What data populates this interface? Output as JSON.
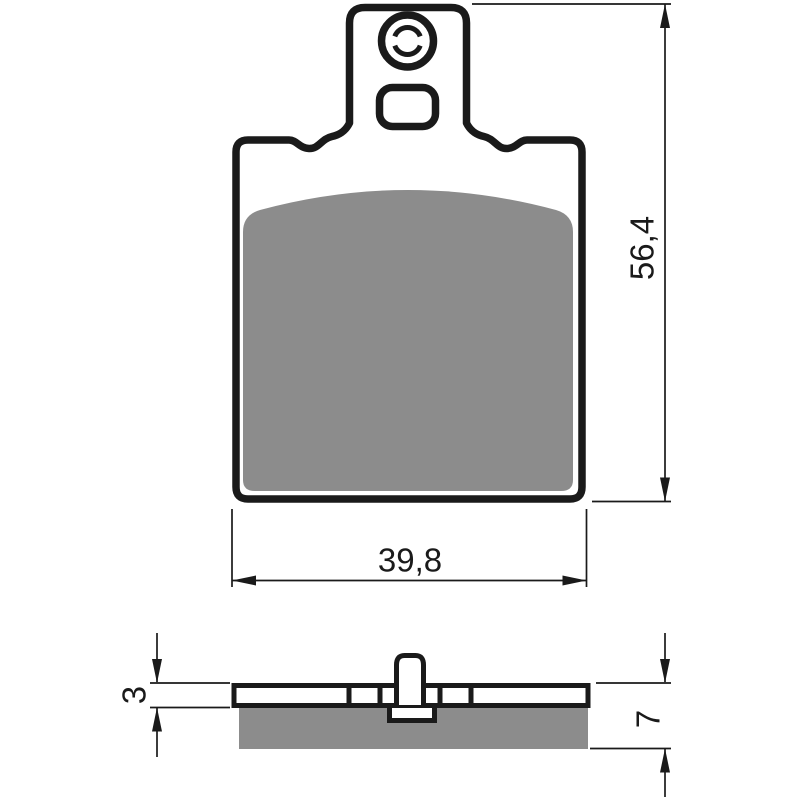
{
  "canvas": {
    "background": "#ffffff",
    "line_color": "#1a1a1a",
    "friction_color": "#8c8c8c"
  },
  "dimensions": {
    "overall_height": "56,4",
    "overall_width": "39,8",
    "backplate_thickness": "3",
    "total_thickness": "7"
  }
}
